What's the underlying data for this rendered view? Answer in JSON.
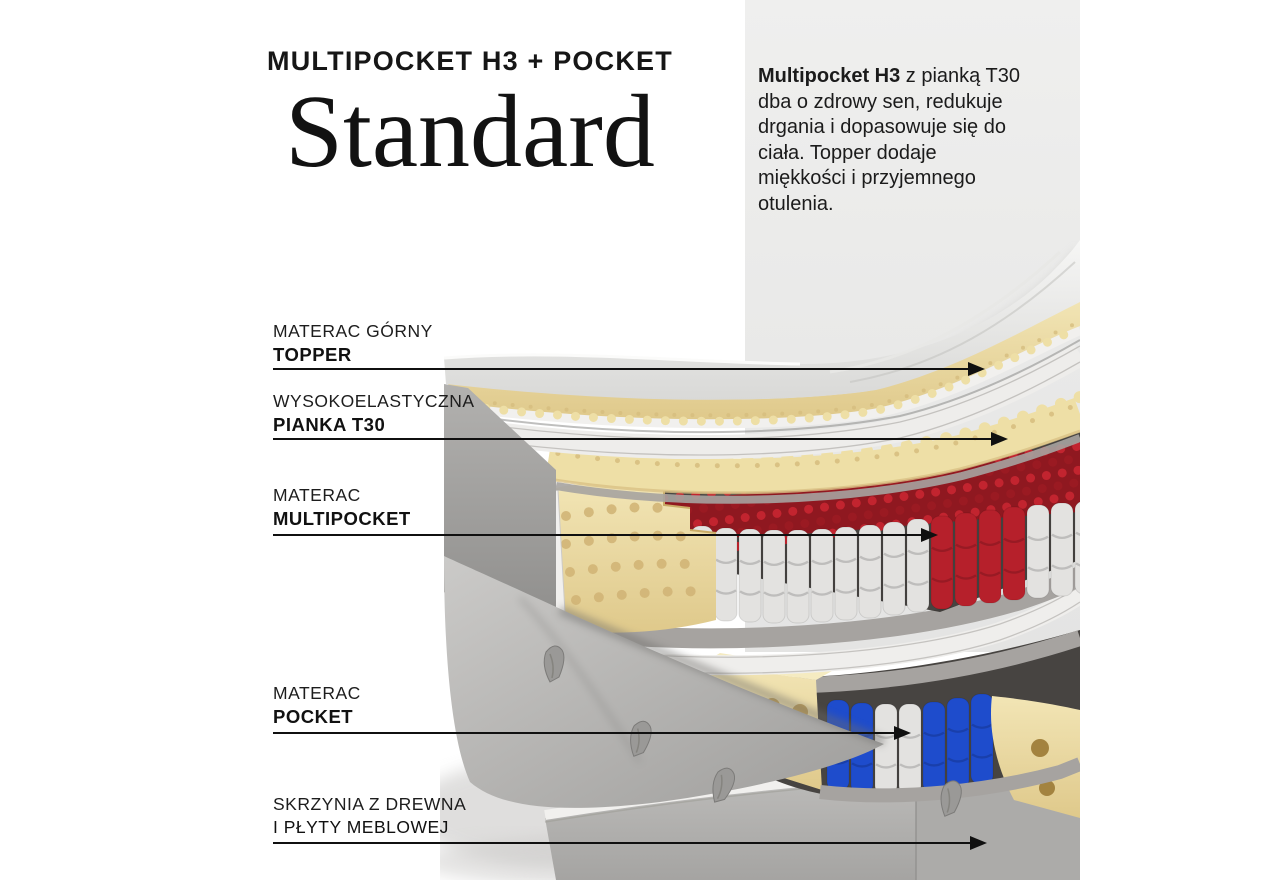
{
  "header": {
    "subtitle": "MULTIPOCKET H3 + POCKET",
    "title": "Standard"
  },
  "description": {
    "lead": "Multipocket H3",
    "after_lead": " z pianką T30",
    "lines": [
      "dba o zdrowy sen, redukuje",
      "drgania i dopasowuje się do",
      "ciała. Topper dodaje",
      "miękkości i przyjemnego",
      "otulenia."
    ]
  },
  "labels": [
    {
      "line1": "MATERAC GÓRNY",
      "line2": "TOPPER"
    },
    {
      "line1": "WYSOKOELASTYCZNA",
      "line2": "PIANKA T30"
    },
    {
      "line1": "MATERAC",
      "line2": "MULTIPOCKET"
    },
    {
      "line1": "MATERAC",
      "line2": "POCKET"
    },
    {
      "line1": "SKRZYNIA Z DREWNA",
      "line2": "I PŁYTY MEBLOWEJ"
    }
  ],
  "colors": {
    "background": "#ffffff",
    "panel_gray": "#e9e9e8",
    "text": "#1b1b1b",
    "foam": "#eedfa6",
    "spring_red": "#b6202b",
    "spring_blue": "#1e4ccc",
    "spring_white": "#e3e2e0",
    "felt": "#a6a3a0",
    "box_fabric": "#b4b3b1"
  }
}
